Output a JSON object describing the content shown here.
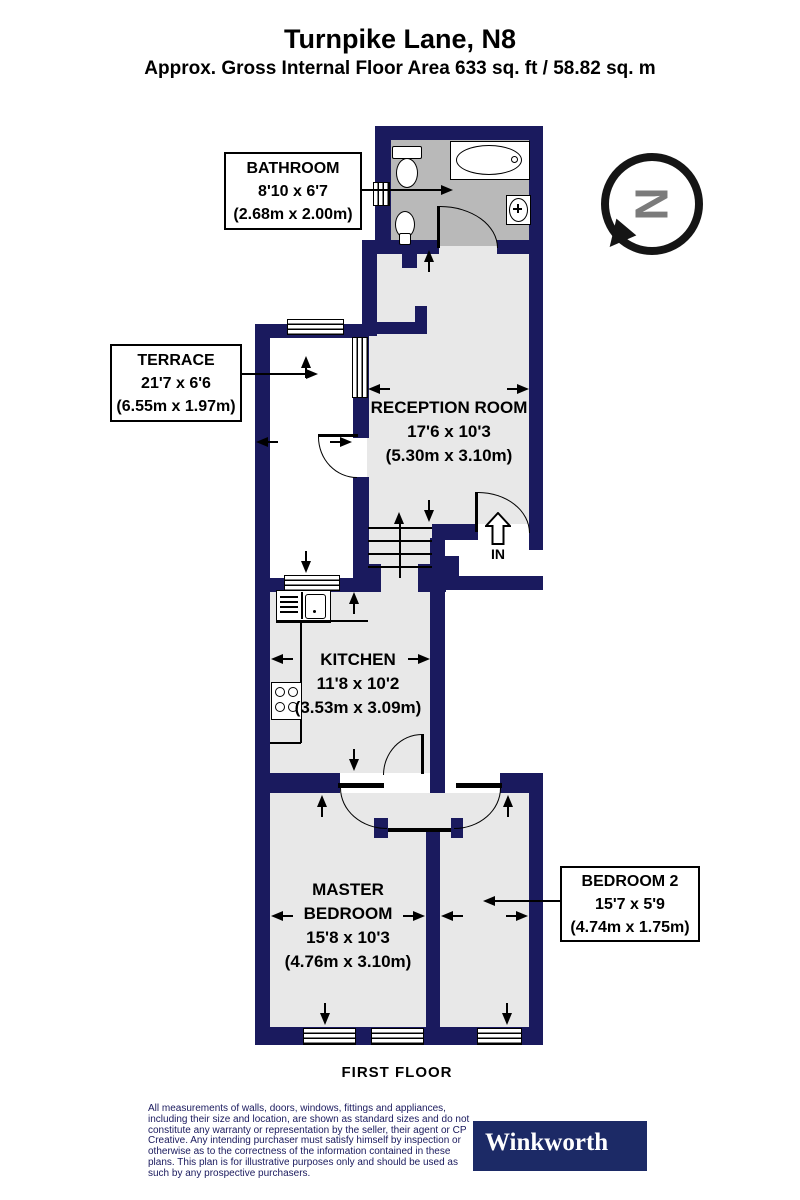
{
  "header": {
    "title": "Turnpike Lane, N8",
    "subtitle": "Approx. Gross Internal Floor Area 633 sq. ft / 58.82 sq. m"
  },
  "rooms": {
    "bathroom": {
      "name": "BATHROOM",
      "dims_ft": "8'10 x 6'7",
      "dims_m": "(2.68m x 2.00m)"
    },
    "terrace": {
      "name": "TERRACE",
      "dims_ft": "21'7 x 6'6",
      "dims_m": "(6.55m x 1.97m)"
    },
    "reception": {
      "name": "RECEPTION ROOM",
      "dims_ft": "17'6 x 10'3",
      "dims_m": "(5.30m x 3.10m)"
    },
    "kitchen": {
      "name": "KITCHEN",
      "dims_ft": "11'8 x 10'2",
      "dims_m": "(3.53m x 3.09m)"
    },
    "master": {
      "name_line1": "MASTER",
      "name_line2": "BEDROOM",
      "dims_ft": "15'8 x 10'3",
      "dims_m": "(4.76m x 3.10m)"
    },
    "bedroom2": {
      "name": "BEDROOM 2",
      "dims_ft": "15'7 x 5'9",
      "dims_m": "(4.74m x 1.75m)"
    }
  },
  "annotations": {
    "entrance": "IN",
    "floor": "FIRST FLOOR",
    "compass": "N"
  },
  "footer": {
    "disclaimer": "All measurements of walls, doors, windows, fittings and appliances, including their size and location, are shown as standard sizes and do not constitute any warranty or representation by the seller, their agent or CP Creative. Any intending purchaser must satisfy himself by inspection or otherwise as to the correctness of the information contained in these plans. This plan is for illustrative purposes only and should be used as such by any prospective purchasers.",
    "brand": "Winkworth"
  },
  "colors": {
    "wall": "#1a1a5e",
    "room_fill": "#e8e8e8",
    "bathroom_fill": "#b9b9b9",
    "brand_bg": "#1c2a66",
    "disclaimer_text": "#1a1a5e",
    "compass_letter": "#7b7b7b"
  }
}
